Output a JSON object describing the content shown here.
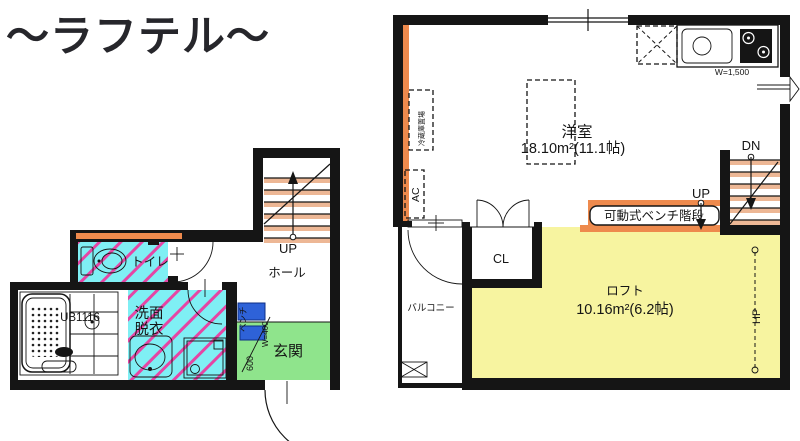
{
  "title": "〜ラフテル〜",
  "floor1": {
    "up_label": "UP",
    "hall_label": "ホール",
    "toilet_label": "トイレ",
    "washroom_label_line1": "洗面",
    "washroom_label_line2": "脱衣",
    "bath_unit_label": "UB1116",
    "entrance_label": "玄関",
    "bench_label": "ベンチ",
    "bench_width_label": "W=400",
    "bench_depth_label": "600"
  },
  "floor2": {
    "room_label": "洋室",
    "room_area_label": "18.10m²(11.1帖)",
    "kitchen_width_label": "W=1,500",
    "fridge_label": "冷蔵庫置場",
    "ac_label": "AC",
    "dn_label": "DN",
    "up_label": "UP",
    "bench_stairs_label": "可動式ベンチ階段",
    "closet_label": "CL",
    "balcony_label": "バルコニー",
    "loft_label": "ロフト",
    "loft_area_label": "10.16m²(6.2帖)",
    "hanger_pipe_label": "HP"
  },
  "colors": {
    "wall": "#151515",
    "wet_area_floor": "#7FEFF4",
    "hatch_stripe": "#E545A4",
    "entrance_floor": "#8FE48C",
    "loft_floor": "#F7F4A0",
    "accent_wall": "#EE8A4D",
    "stair_tread": "#EDB795",
    "bench": "#2E62D8"
  }
}
